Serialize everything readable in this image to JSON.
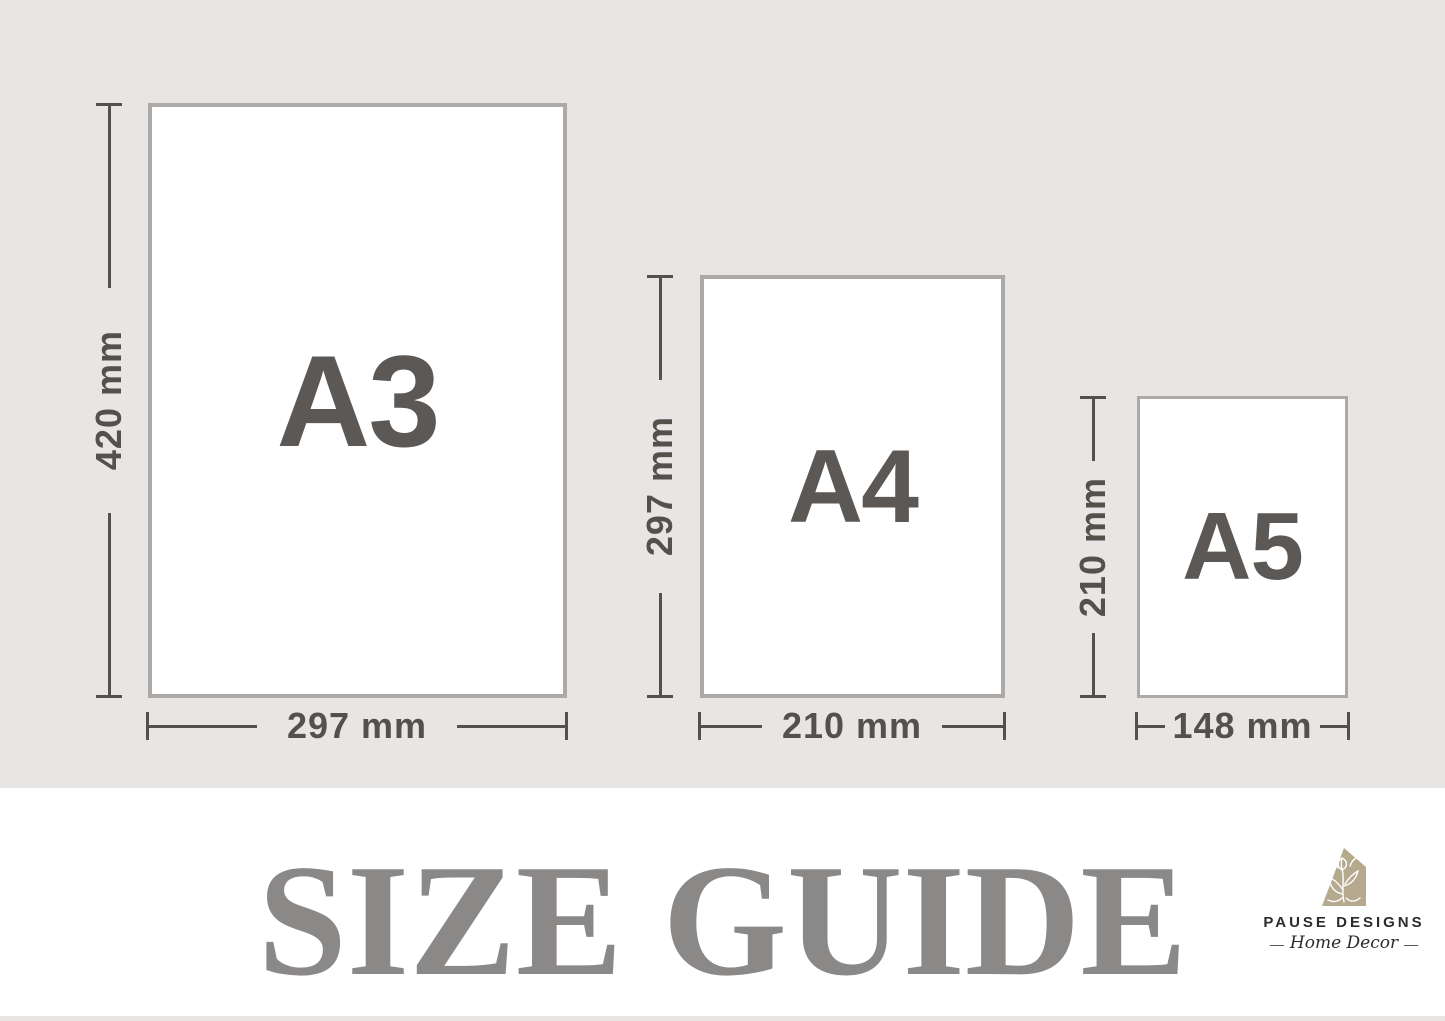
{
  "papers": [
    {
      "name": "A3",
      "height": "420 mm",
      "width": "297 mm"
    },
    {
      "name": "A4",
      "height": "297 mm",
      "width": "210 mm"
    },
    {
      "name": "A5",
      "height": "210 mm",
      "width": "148 mm"
    }
  ],
  "footer": {
    "title": "SIZE GUIDE",
    "brand": "PAUSE DESIGNS",
    "tagline": "Home Decor",
    "dash": "—",
    "house_icon": "house-botanical-icon"
  },
  "colors": {
    "background": "#e8e6e4",
    "paper": "#ffffff",
    "paper_border": "#aca9a6",
    "dimension": "#54514d",
    "paper_label": "#5b5855",
    "title": "#8b8888",
    "logo_house": "#b5a98e",
    "logo_text": "#2b2b2b"
  }
}
